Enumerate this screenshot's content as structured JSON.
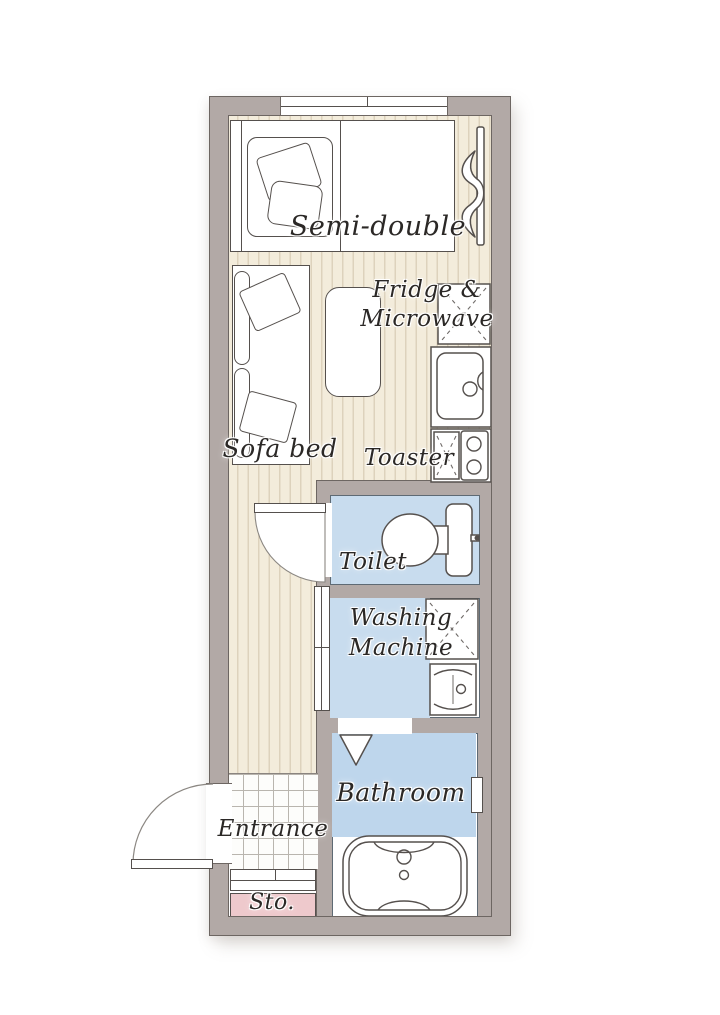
{
  "colors": {
    "wall": "#b2a9a6",
    "wall_outline": "#6d6662",
    "floor": "#f3ecdb",
    "floor_stripe": "#ddd2bc",
    "tile_line": "#b9b5ae",
    "water_blue": "#c8dcee",
    "bath_blue": "#bed6ec",
    "storage_pink": "#eec9cc",
    "ink": "#2b2826"
  },
  "rooms": {
    "bed_label": "Semi-double",
    "fridge_label_line1": "Fridge &",
    "fridge_label_line2": "Microwave",
    "sofa_label": "Sofa bed",
    "toaster_label": "Toaster",
    "toilet_label": "Toilet",
    "washing_label_line1": "Washing",
    "washing_label_line2": "Machine",
    "bathroom_label": "Bathroom",
    "entrance_label": "Entrance",
    "storage_label": "Sto."
  }
}
